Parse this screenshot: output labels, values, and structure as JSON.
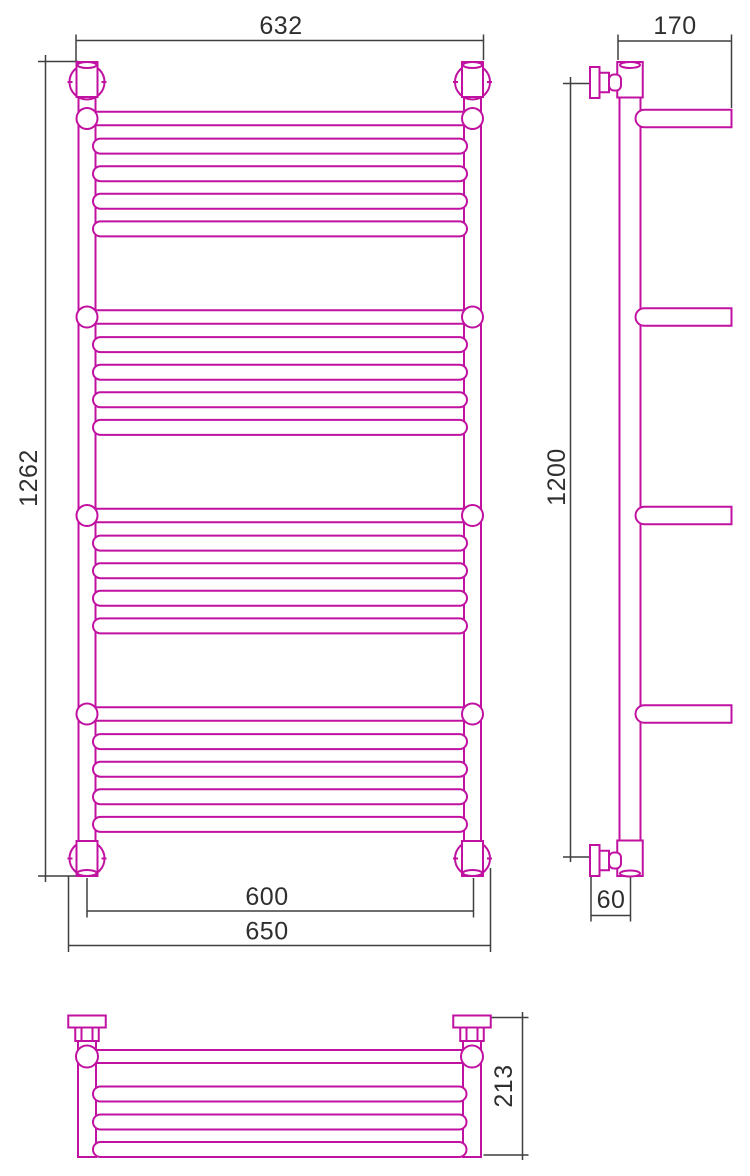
{
  "colors": {
    "product": "#c011a0",
    "dimension": "#3f3f3f",
    "text": "#2f2f2f",
    "background": "#ffffff"
  },
  "labels": {
    "front_width_top": "632",
    "front_height": "1262",
    "front_rail_centers": "600",
    "front_width_outer": "650",
    "side_depth": "170",
    "side_height": "1200",
    "side_wall_offset": "60",
    "bottom_depth": "213"
  },
  "geometry": {
    "front": {
      "rails": {
        "cxs": [
          87,
          472.5
        ],
        "w": 17,
        "top": 63,
        "bottom": 876
      },
      "collar": {
        "w": 21,
        "h": 35,
        "top_y": 62,
        "bottom_y": 841,
        "cap_rx": 9.5,
        "cap_ry": 3
      },
      "fitting_circle": {
        "r": 17.5,
        "top_cy": 82,
        "bottom_cy": 858.5
      },
      "shelf_bars": {
        "cys": [
          118.5,
          317,
          515.5,
          714
        ],
        "h": 13.5,
        "end_r": 10.5
      },
      "rungs": {
        "offsets": [
          27.6,
          55.2,
          82.8,
          110.4
        ],
        "h": 15,
        "x1": 93,
        "x2": 467
      }
    },
    "side": {
      "tube": {
        "cx": 630,
        "w": 21,
        "top": 63,
        "bottom": 876
      },
      "collar": {
        "w": 25.5,
        "h": 35.5,
        "top_y": 62,
        "bottom_y": 840.5,
        "cap_rx": 10,
        "cap_ry": 3
      },
      "valves": {
        "cys": [
          82.5,
          860.5
        ],
        "flange_x": 590,
        "flange_w": 9.5,
        "flange_h": 31,
        "nut_w": 9.5,
        "nut_h": 19.5,
        "cone_w": 12,
        "cone_h": 16
      },
      "arms": {
        "cys": [
          118.5,
          317,
          515.5,
          714
        ],
        "x1": 635.5,
        "x2": 731.5,
        "h": 17.5
      }
    },
    "bottom": {
      "posts": {
        "cxs": [
          87,
          472
        ],
        "w": 18,
        "top": 1036,
        "bottom": 1157
      },
      "hat": {
        "cap_w": 37.5,
        "cap_h": 12,
        "cap_y": 1015.5,
        "nut_w": 23.5,
        "nut_h": 13.5,
        "facet_dx": 5.5
      },
      "end_circle": {
        "cy": 1056.5,
        "r": 11
      },
      "top_bar_h": 13,
      "bars": {
        "cys": [
          1094,
          1122,
          1149.5
        ],
        "x1": 93,
        "x2": 466.5,
        "h": 15
      }
    },
    "dimensions": [
      {
        "id": "front_width_top",
        "orient": "h",
        "y": 40.5,
        "x1": 76,
        "x2": 483.5,
        "exts": [
          [
            76,
            34.5,
            62
          ],
          [
            483.5,
            34.5,
            60
          ]
        ],
        "tx": 281,
        "ty": 26,
        "rot": 0
      },
      {
        "id": "front_height",
        "orient": "v",
        "x": 45.5,
        "y1": 55,
        "y2": 882,
        "exts": [
          [
            61.5,
            38,
            78.5
          ],
          [
            876,
            38,
            77
          ]
        ],
        "tx": 29,
        "ty": 478,
        "rot": 1
      },
      {
        "id": "front_rail_centers",
        "orient": "h",
        "y": 911,
        "x1": 87,
        "x2": 473.5,
        "exts": [
          [
            87,
            878,
            917.5
          ],
          [
            473.5,
            878,
            917.5
          ]
        ],
        "tx": 267,
        "ty": 897,
        "rot": 0
      },
      {
        "id": "front_width_outer",
        "orient": "h",
        "y": 945.5,
        "x1": 68.5,
        "x2": 490.5,
        "exts": [
          [
            68.5,
            876,
            952
          ],
          [
            490.5,
            868,
            952
          ]
        ],
        "tx": 267,
        "ty": 931.5,
        "rot": 0
      },
      {
        "id": "side_depth",
        "orient": "h",
        "y": 41,
        "x1": 618,
        "x2": 731.5,
        "exts": [
          [
            618,
            34.5,
            60
          ],
          [
            731.5,
            34.5,
            108
          ]
        ],
        "tx": 675,
        "ty": 26,
        "rot": 0
      },
      {
        "id": "side_height",
        "orient": "v",
        "x": 570.5,
        "y1": 77,
        "y2": 862,
        "exts": [
          [
            83.5,
            563,
            590
          ],
          [
            857,
            563,
            590
          ]
        ],
        "tx": 557,
        "ty": 477,
        "rot": 1
      },
      {
        "id": "side_wall_offset",
        "orient": "h",
        "y": 915.5,
        "x1": 591,
        "x2": 630.5,
        "exts": [
          [
            591,
            877,
            921.5
          ],
          [
            630.5,
            877,
            921.5
          ]
        ],
        "tx": 611,
        "ty": 900,
        "rot": 0
      },
      {
        "id": "bottom_depth",
        "orient": "v",
        "x": 522.5,
        "y1": 1012,
        "y2": 1160,
        "exts": [
          [
            1017.5,
            491,
            528.5
          ],
          [
            1155,
            483.5,
            528.5
          ]
        ],
        "tx": 504,
        "ty": 1086,
        "rot": 1
      }
    ]
  }
}
